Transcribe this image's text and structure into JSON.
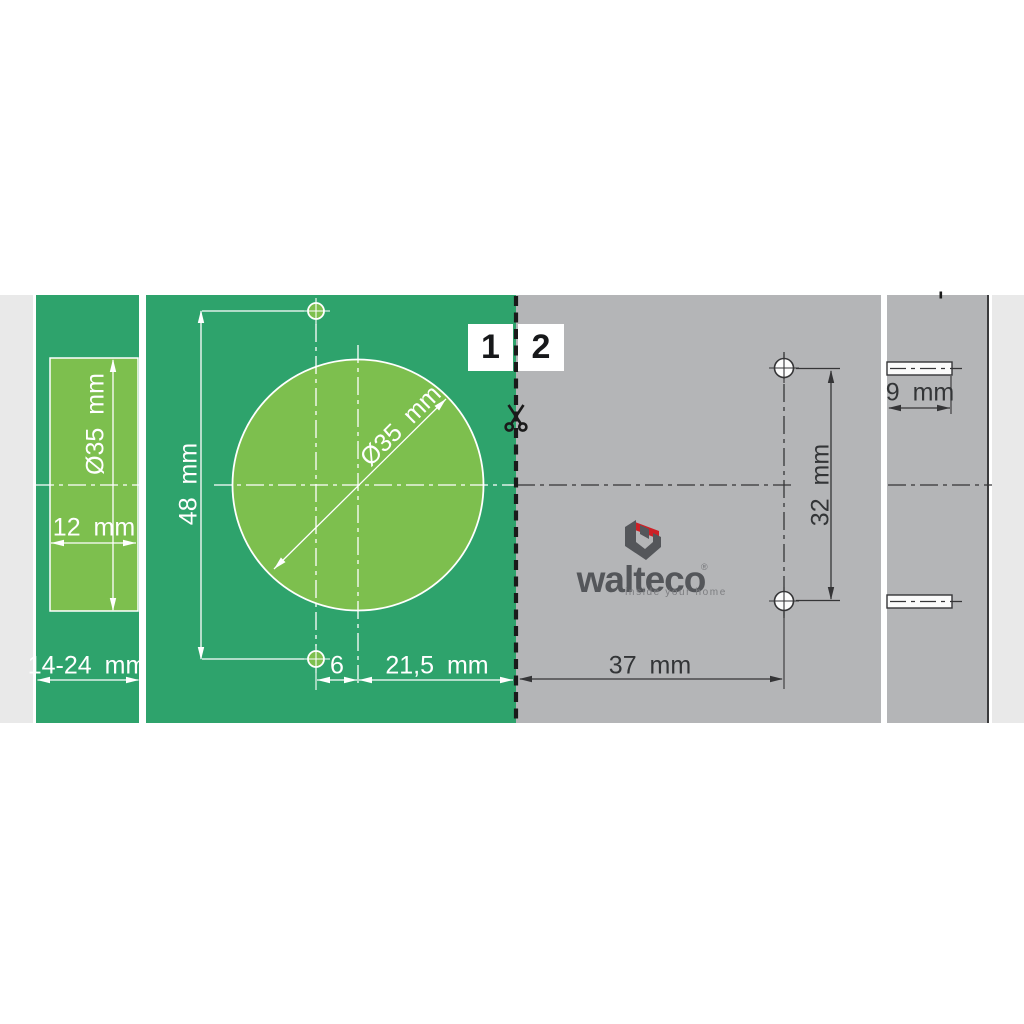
{
  "title": "Hinge drilling template",
  "brand": {
    "name": "walteco",
    "registered_mark": "®",
    "tagline": "inside your home"
  },
  "steps": [
    {
      "label": "1"
    },
    {
      "label": "2"
    }
  ],
  "dims": {
    "strip_diameter": "Ø35 mm",
    "strip_width": "12 mm",
    "overlay_range": "14-24 mm",
    "height_48": "48 mm",
    "cup_diameter": "Ø35 mm",
    "offset_6": "6",
    "offset_21_5": "21,5 mm",
    "offset_37": "37 mm",
    "spacing_32": "32 mm",
    "depth_9": "9 mm"
  },
  "icons": {
    "scissors": "cut-along-dashed-line"
  },
  "colors": {
    "green_dark": "#2ea36c",
    "green_light": "#7dbf4e",
    "panel_gray": "#b4b5b7",
    "background_gray": "#e9e9e9",
    "line_dark": "#353537",
    "cut_line_black": "#1a1a1a",
    "logo_gray": "#54565a",
    "logo_red": "#cd2026",
    "drawing_white": "#ffffff"
  }
}
